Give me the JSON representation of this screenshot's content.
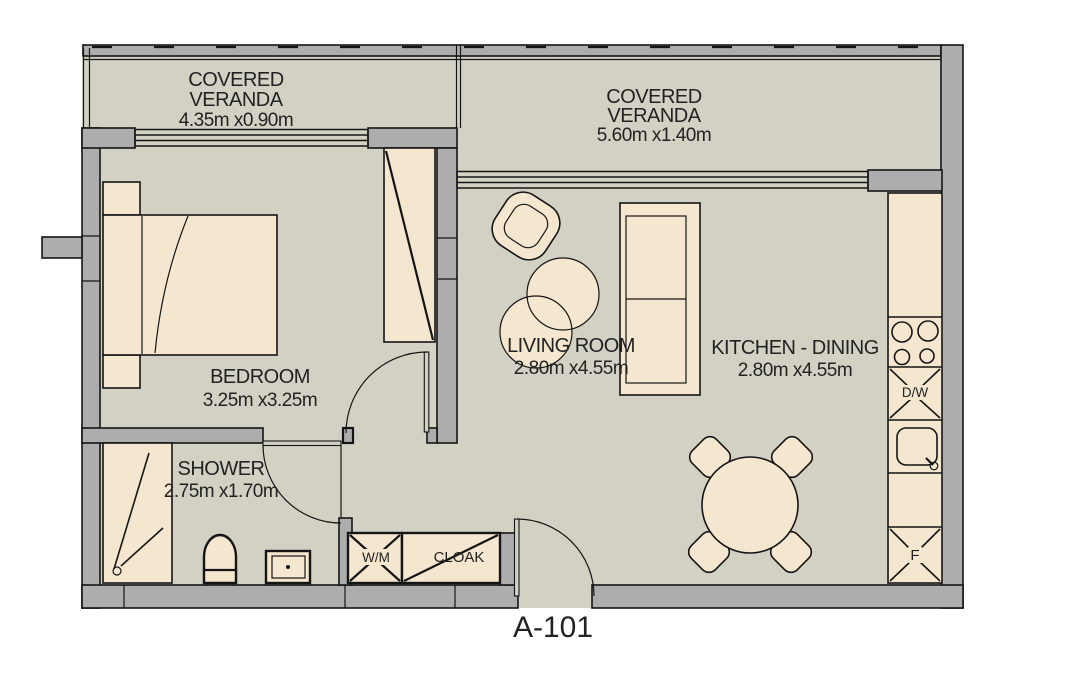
{
  "plan": {
    "unit_label": "A-101",
    "rooms": {
      "veranda_left": {
        "line1": "COVERED",
        "line2": "VERANDA",
        "dims": "4.35m x0.90m"
      },
      "veranda_right": {
        "line1": "COVERED",
        "line2": "VERANDA",
        "dims": "5.60m x1.40m"
      },
      "bedroom": {
        "name": "BEDROOM",
        "dims": "3.25m x3.25m"
      },
      "shower": {
        "name": "SHOWER",
        "dims": "2.75m x1.70m"
      },
      "living_room": {
        "name": "LIVING ROOM",
        "dims": "2.80m x4.55m"
      },
      "kitchen_dining": {
        "name": "KITCHEN - DINING",
        "dims": "2.80m x4.55m"
      }
    },
    "fixtures": {
      "washing_machine": "W/M",
      "cloakroom": "CLOAK",
      "dishwasher": "D/W",
      "fridge": "F"
    },
    "colors": {
      "floor": "#d2d1c4",
      "furniture": "#f4e6cf",
      "wall": "#aeadad",
      "line": "#151515",
      "text": "#222222",
      "background": "#ffffff"
    }
  }
}
